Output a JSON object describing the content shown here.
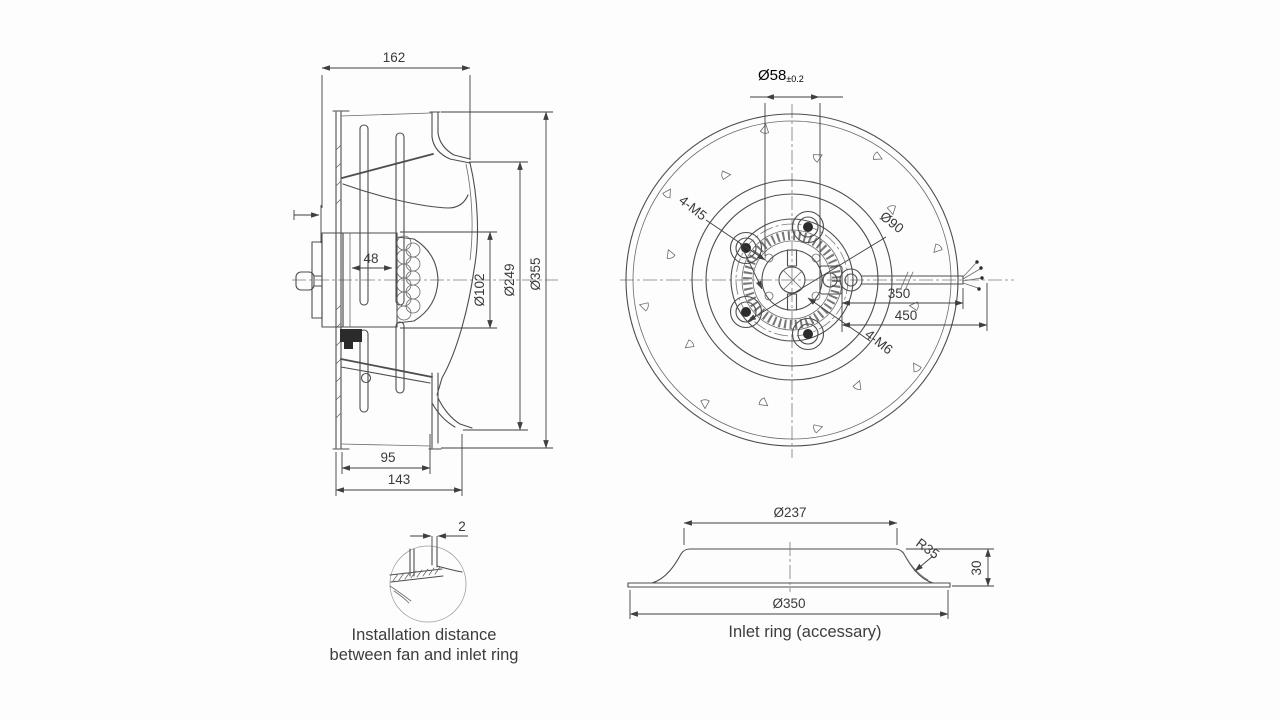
{
  "side_view": {
    "dim_overall_depth": "162",
    "dim_motor_depth": "48",
    "dim_motor_dia": "Ø102",
    "dim_inlet_dia": "Ø249",
    "dim_impeller_dia": "Ø355",
    "dim_rim_depth": "95",
    "dim_housing_depth": "143"
  },
  "front_view": {
    "dim_hub_circle": "Ø58",
    "dim_hub_tol": "±0.2",
    "label_holes_m5": "4-M5",
    "dim_bolt_circle": "Ø90",
    "label_bolts_m6": "4-M6",
    "dim_cable_350": "350",
    "dim_cable_450": "450"
  },
  "detail_view": {
    "dim_gap": "2",
    "caption_line1": "Installation distance",
    "caption_line2": "between fan and inlet ring"
  },
  "inlet_ring": {
    "dim_inner_dia": "Ø237",
    "dim_fillet": "R35",
    "dim_height": "30",
    "dim_outer_dia": "Ø350",
    "caption": "Inlet ring (accessary)"
  },
  "colors": {
    "line": "#4d4d4d",
    "dim_text": "#3a3a3a",
    "background": "#fdfdfd"
  }
}
